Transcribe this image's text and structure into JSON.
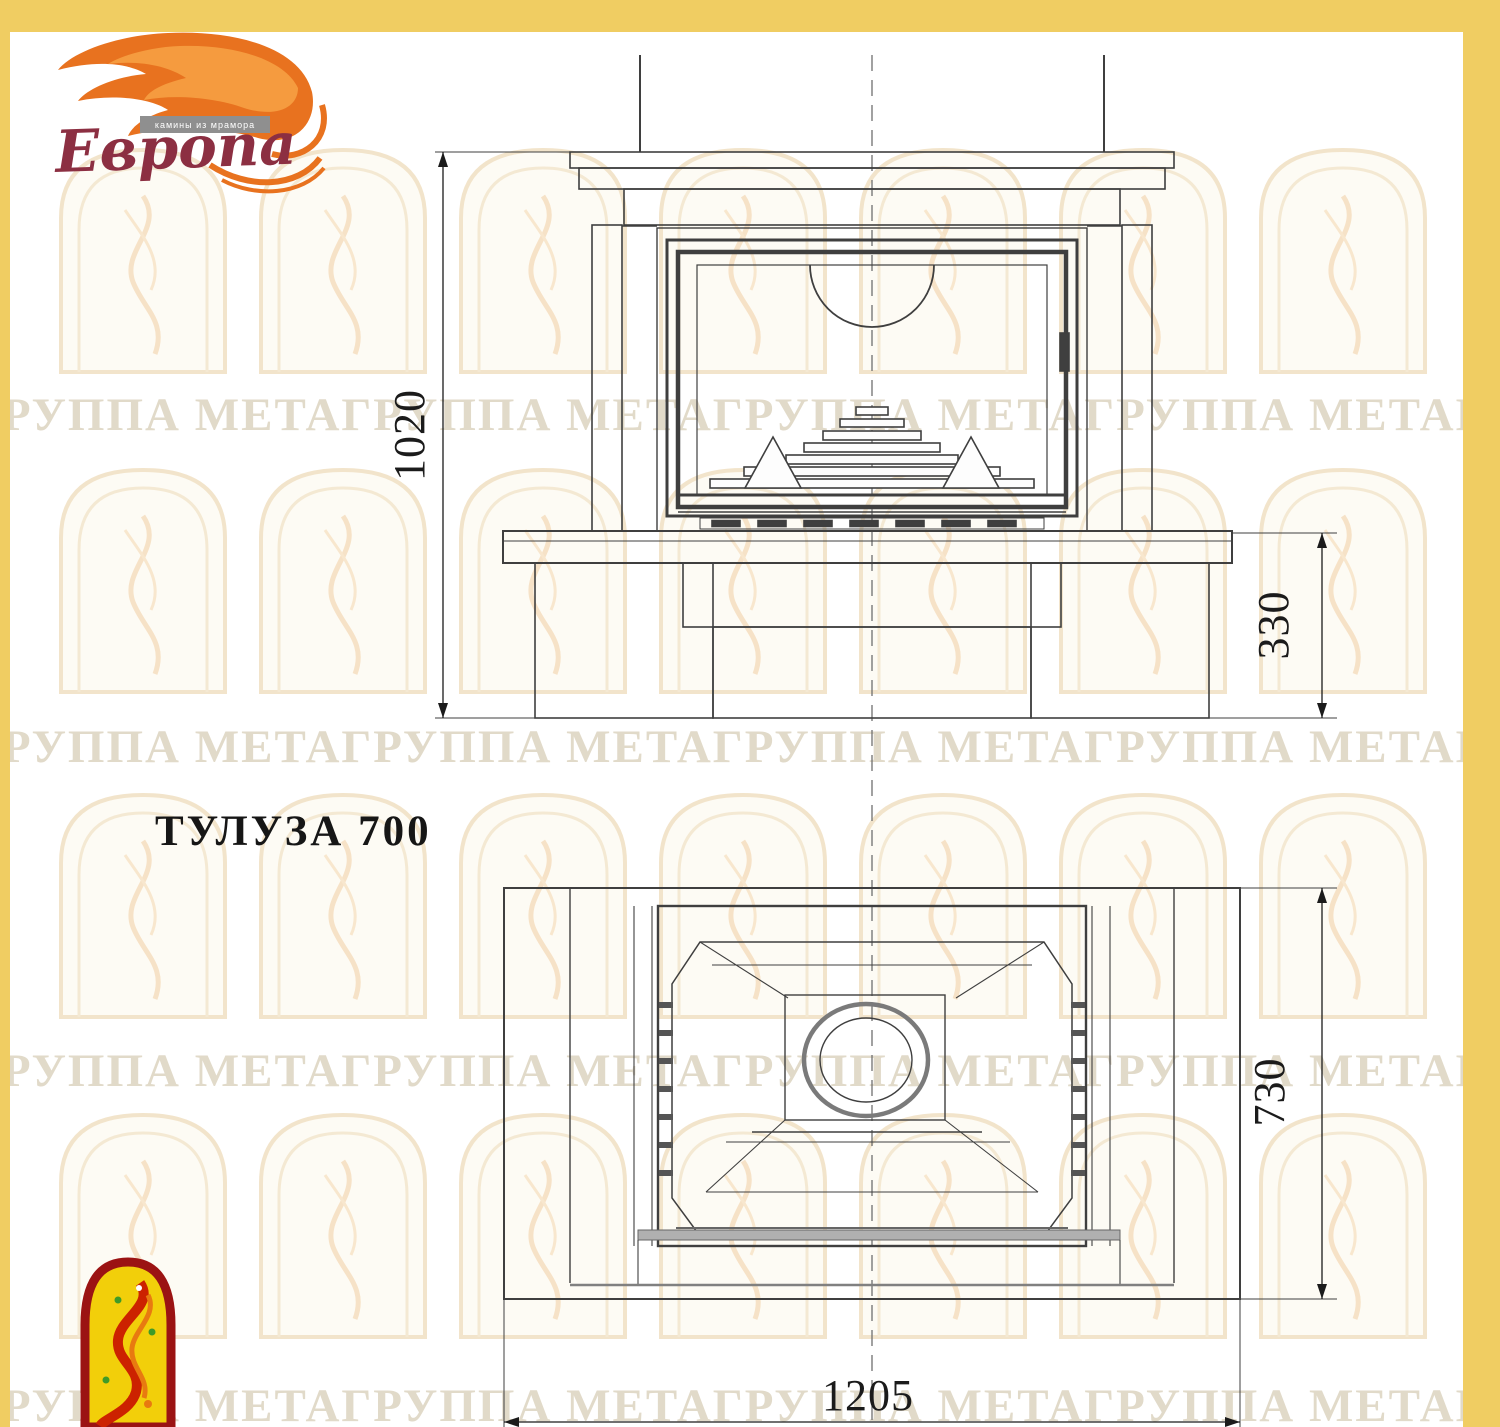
{
  "page": {
    "background": "#ffffff",
    "frame_color": "#f0cd62"
  },
  "logo": {
    "name": "Европа",
    "tagline": "камины из мрамора",
    "flame_color": "#e8721f",
    "script_color": "#8c2f42",
    "tagline_bar_color": "#8f8f8f"
  },
  "title": "ТУЛУЗА 700",
  "watermark": {
    "text": "ГРУППА МЕТАГРУППА МЕТАГРУППА МЕТАГРУППА МЕТАГРУППА",
    "text_color": "#c9bc9e",
    "arch_line_color": "#f0e0c2"
  },
  "drawing": {
    "line_color": "#3f3f3f",
    "dimensions": {
      "front_overall_height": "1020",
      "front_plinth_height": "330",
      "plan_depth": "730",
      "plan_width": "1205"
    }
  }
}
